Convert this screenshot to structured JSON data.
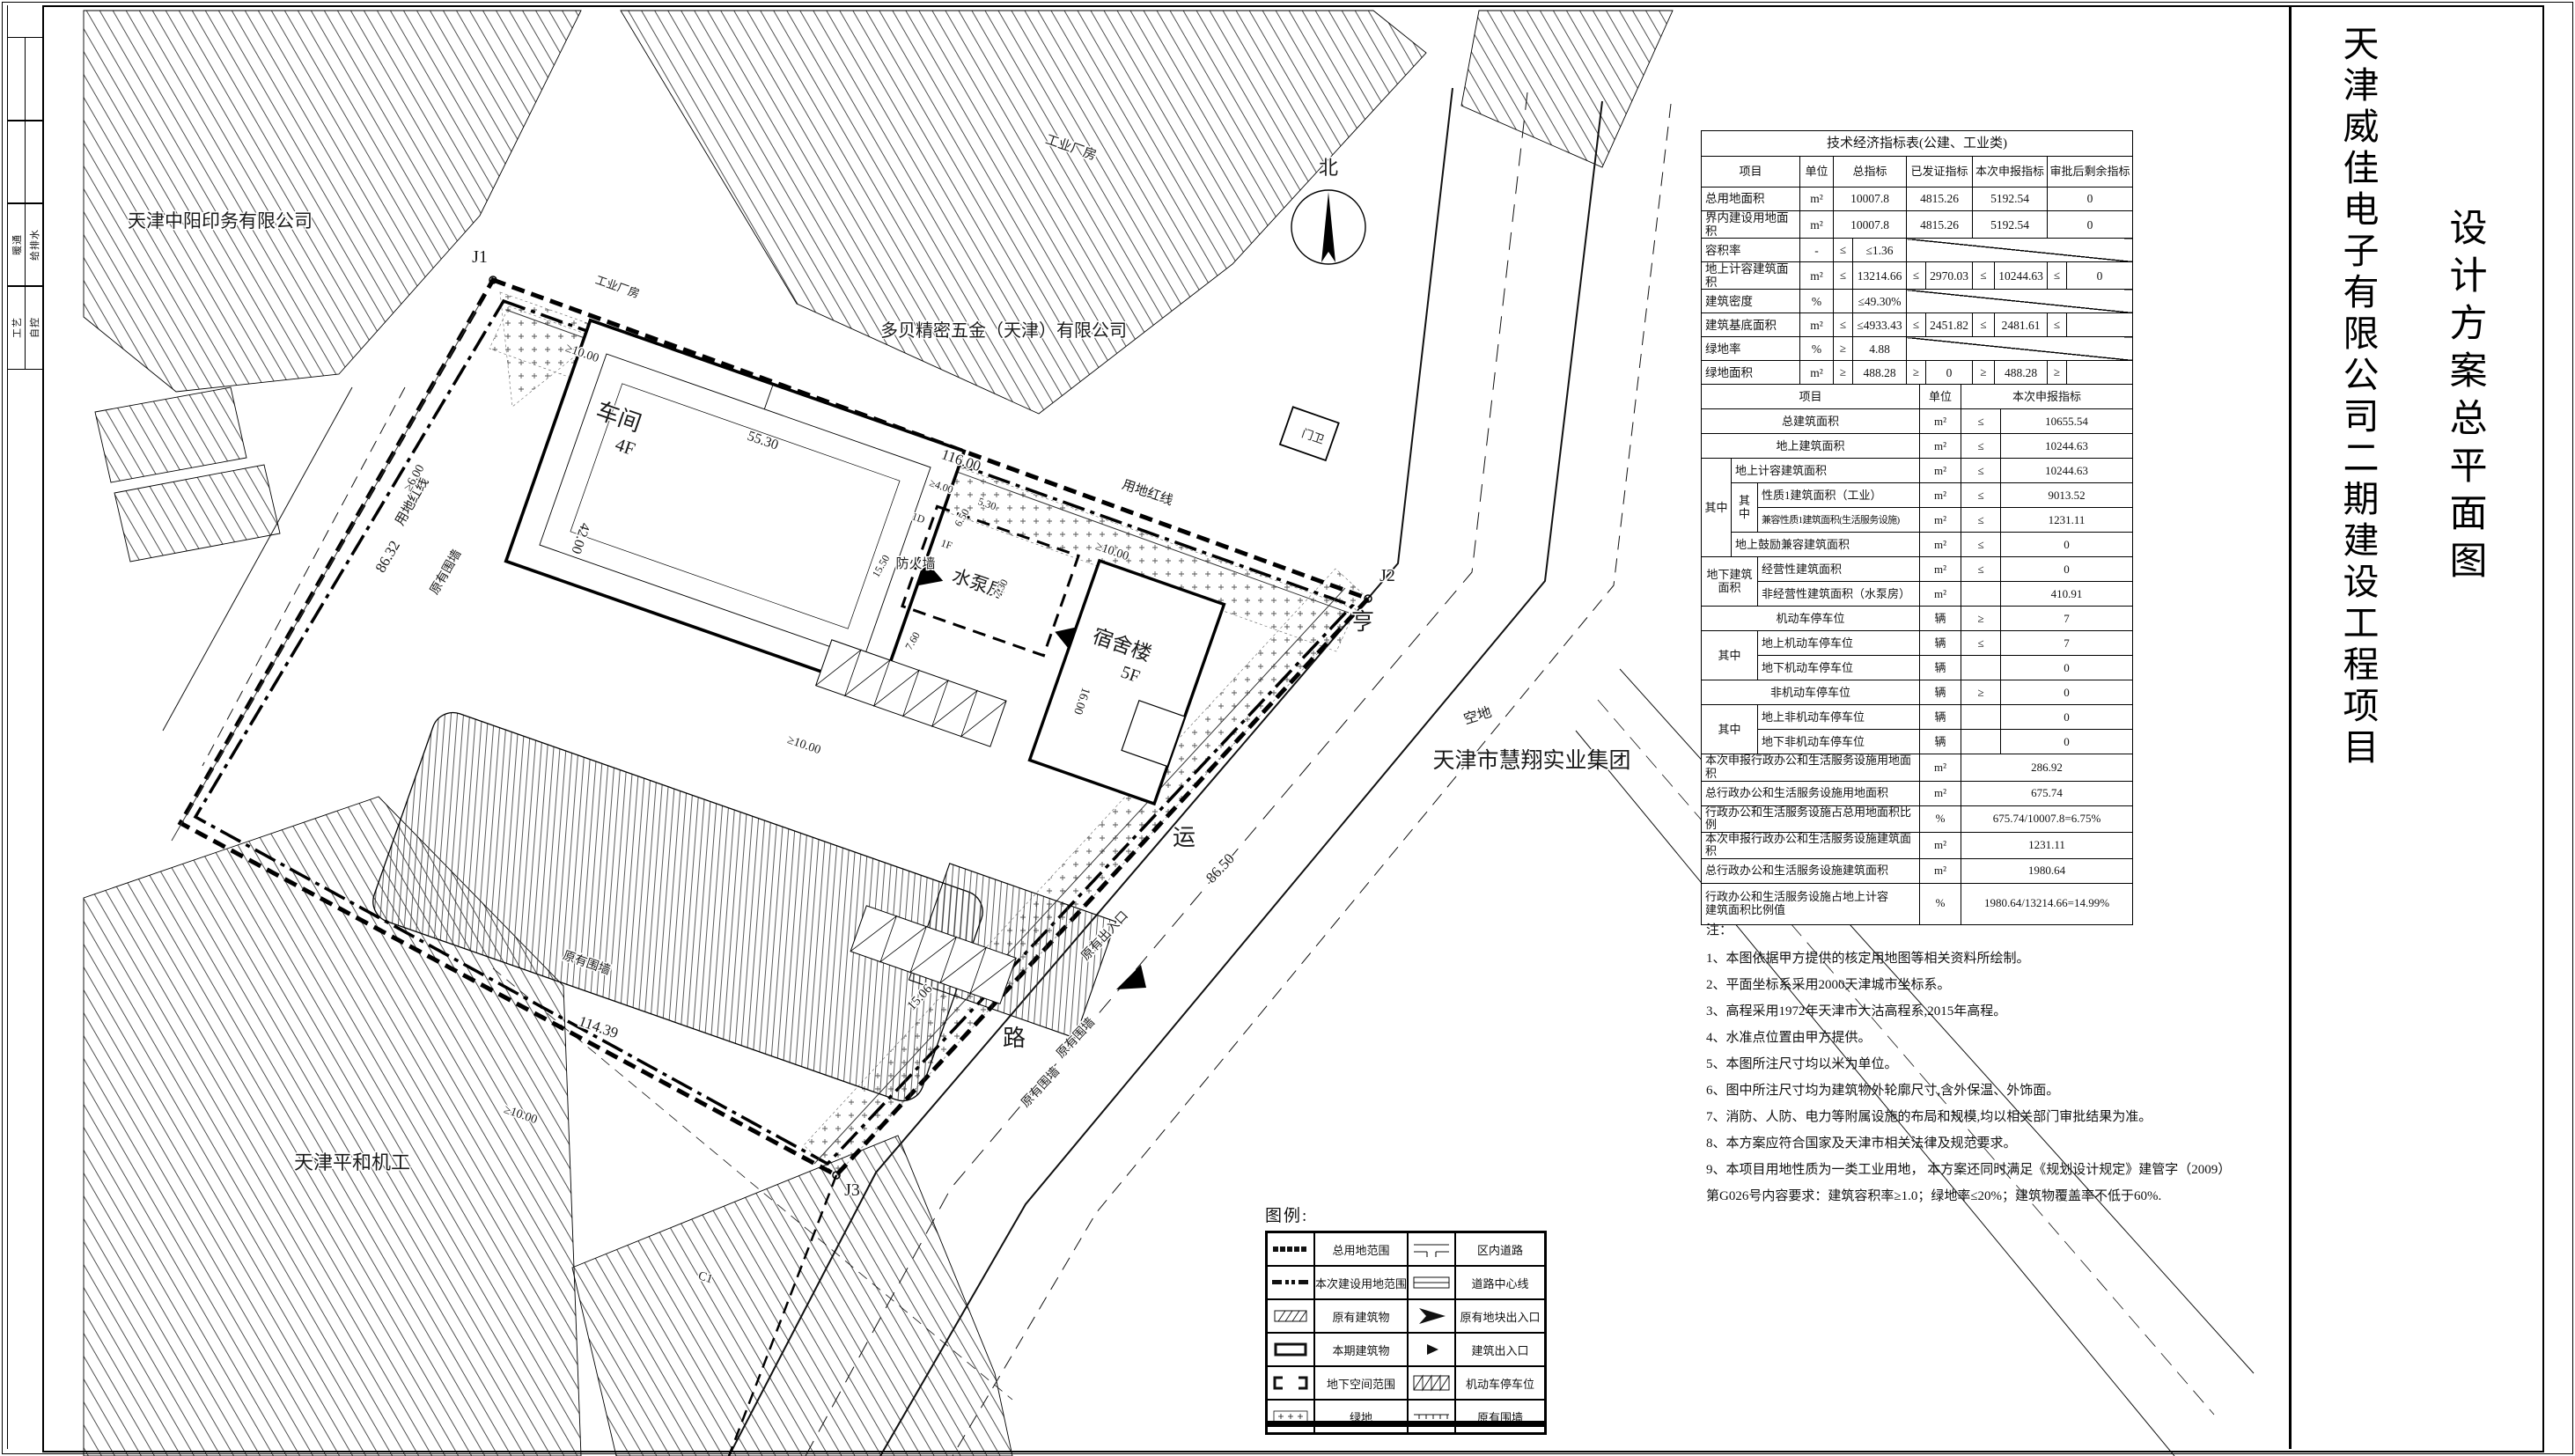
{
  "titles": {
    "project": "天津威佳电子有限公司二期建设工程项目",
    "drawing": "设计方案总平面图"
  },
  "titleblock": {
    "rows": [
      [
        "",
        ""
      ],
      [
        "",
        ""
      ],
      [
        "暖通",
        "给排水"
      ],
      [
        "工艺",
        "自控"
      ]
    ]
  },
  "north": {
    "label": "北"
  },
  "map": {
    "labels": [
      [
        "天津中阳印务有限公司",
        250,
        258,
        0,
        21,
        "#222"
      ],
      [
        "多贝精密五金（天津）有限公司",
        1140,
        382,
        0,
        20,
        "#222"
      ],
      [
        "工业厂房",
        1215,
        172,
        19,
        15,
        "#555"
      ],
      [
        "工业厂房",
        700,
        330,
        19,
        13,
        "#777"
      ],
      [
        "天津平和机工",
        400,
        1328,
        0,
        22,
        "#222"
      ],
      [
        "天津市慧翔实业集团",
        1740,
        872,
        0,
        25,
        "#111"
      ],
      [
        "空地",
        1680,
        818,
        -17,
        16,
        "#444"
      ],
      [
        "C1",
        800,
        1455,
        19,
        14,
        "#666"
      ],
      [
        "亨",
        1548,
        715,
        0,
        26,
        "#111"
      ],
      [
        "运",
        1345,
        960,
        0,
        26,
        "#111"
      ],
      [
        "路",
        1152,
        1188,
        0,
        26,
        "#111"
      ],
      [
        "车间",
        700,
        482,
        19,
        26,
        "#333"
      ],
      [
        "4F",
        708,
        514,
        19,
        21,
        "#333"
      ],
      [
        "宿舍楼",
        1272,
        740,
        19,
        23,
        "#333"
      ],
      [
        "5F",
        1282,
        772,
        19,
        20,
        "#333"
      ],
      [
        "水泵房",
        1110,
        670,
        19,
        21,
        "#333"
      ],
      [
        "门卫",
        1490,
        500,
        19,
        13,
        "#444"
      ],
      [
        "1D",
        1042,
        592,
        19,
        12,
        "#666"
      ],
      [
        "1F",
        1074,
        622,
        19,
        12,
        "#666"
      ],
      [
        "J1",
        545,
        298,
        0,
        20,
        "#111"
      ],
      [
        "J2",
        1576,
        660,
        0,
        20,
        "#111"
      ],
      [
        "J3",
        968,
        1358,
        0,
        20,
        "#111"
      ],
      [
        "用地红线",
        1302,
        564,
        19,
        15,
        "#111"
      ],
      [
        "用地红线",
        472,
        572,
        -60,
        15,
        "#111"
      ],
      [
        "原有围墙",
        510,
        652,
        -60,
        14,
        "#111"
      ],
      [
        "原有围墙",
        665,
        1098,
        19,
        14,
        "#111"
      ],
      [
        "原有围墙",
        1225,
        1182,
        -47,
        14,
        "#111"
      ],
      [
        "原有围墙",
        1185,
        1238,
        -47,
        14,
        "#111"
      ],
      [
        "防火墙",
        1040,
        645,
        0,
        15,
        "#111"
      ],
      [
        "原有出入口",
        1258,
        1066,
        -47,
        14,
        "#111"
      ],
      [
        "北",
        1509,
        198,
        0,
        22,
        "#111"
      ],
      [
        "116.00",
        1090,
        528,
        19,
        17,
        "#111"
      ],
      [
        "55.30",
        865,
        505,
        19,
        16,
        "#111"
      ],
      [
        "42.00",
        655,
        610,
        109,
        16,
        "#111"
      ],
      [
        "86.32",
        445,
        635,
        -60,
        17,
        "#111"
      ],
      [
        "114.39",
        678,
        1172,
        19,
        17,
        "#111"
      ],
      [
        "86.50",
        1390,
        990,
        -47,
        17,
        "#111"
      ],
      [
        "15.06",
        1048,
        1136,
        -47,
        15,
        "#111"
      ],
      [
        "≥10.00",
        660,
        405,
        19,
        14,
        "#111"
      ],
      [
        "≥10.00",
        1262,
        630,
        19,
        14,
        "#111"
      ],
      [
        "≥10.00",
        912,
        850,
        19,
        14,
        "#111"
      ],
      [
        "≥10.00",
        590,
        1270,
        19,
        14,
        "#111"
      ],
      [
        "≥6.00",
        474,
        545,
        -60,
        14,
        "#111"
      ],
      [
        "≥4.00",
        1068,
        556,
        19,
        12,
        "#111"
      ],
      [
        "5.30",
        1120,
        576,
        19,
        12,
        "#111"
      ],
      [
        "15.50",
        1004,
        645,
        -60,
        12,
        "#111"
      ],
      [
        "7.60",
        1040,
        730,
        -60,
        12,
        "#111"
      ],
      [
        "7.30",
        1140,
        670,
        -60,
        12,
        "#111"
      ],
      [
        "6.50",
        1096,
        590,
        -60,
        12,
        "#111"
      ],
      [
        "16.00",
        1225,
        795,
        109,
        14,
        "#111"
      ]
    ]
  },
  "table": {
    "title": "技术经济指标表(公建、工业类)",
    "header": [
      "项目",
      "单位",
      "总指标",
      "已发证指标",
      "本次申报指标",
      "审批后剩余指标"
    ],
    "rows_a": [
      [
        "总用地面积",
        "m²",
        "10007.8",
        "4815.26",
        "5192.54",
        "0"
      ],
      [
        "界内建设用地面积",
        "m²",
        "10007.8",
        "4815.26",
        "5192.54",
        "0"
      ],
      {
        "label": "容积率",
        "unit": "-",
        "sym": "≤",
        "val": "≤1.36",
        "diag": true
      },
      {
        "label": "地上计容建筑面积",
        "unit": "m²",
        "cells": [
          [
            "≤",
            "13214.66"
          ],
          [
            "≤",
            "2970.03"
          ],
          [
            "≤",
            "10244.63"
          ],
          [
            "≤",
            "0"
          ]
        ]
      },
      {
        "label": "建筑密度",
        "unit": "%",
        "sym": "",
        "val": "≤49.30%",
        "diag": true
      },
      {
        "label": "建筑基底面积",
        "unit": "m²",
        "cells": [
          [
            "≤",
            "≤4933.43"
          ],
          [
            "≤",
            "2451.82"
          ],
          [
            "≤",
            "2481.61"
          ],
          [
            "≤",
            ""
          ]
        ]
      },
      {
        "label": "绿地率",
        "unit": "%",
        "sym": "≥",
        "val": "4.88",
        "diag": true
      },
      {
        "label": "绿地面积",
        "unit": "m²",
        "cells": [
          [
            "≥",
            "488.28"
          ],
          [
            "≥",
            "0"
          ],
          [
            "≥",
            "488.28"
          ],
          [
            "≥",
            ""
          ]
        ]
      }
    ],
    "header_b": [
      "项目",
      "单位",
      "本次申报指标"
    ],
    "rows_b": [
      {
        "label": "总建筑面积",
        "unit": "m²",
        "sym": "≤",
        "val": "10655.54",
        "span": 3
      },
      {
        "label": "地上建筑面积",
        "unit": "m²",
        "sym": "≤",
        "val": "10244.63",
        "span": 3
      },
      {
        "g1": "其中",
        "g1rs": 4,
        "label": "地上计容建筑面积",
        "unit": "m²",
        "sym": "≤",
        "val": "10244.63",
        "span": 2
      },
      {
        "g2": "其中",
        "g2rs": 2,
        "label": "性质1建筑面积（工业）",
        "unit": "m²",
        "sym": "≤",
        "val": "9013.52",
        "span": 1
      },
      {
        "label": "兼容性质1建筑面积(生活服务设施)",
        "unit": "m²",
        "sym": "≤",
        "val": "1231.11",
        "span": 1,
        "small": true
      },
      {
        "label": "地上鼓励兼容建筑面积",
        "unit": "m²",
        "sym": "≤",
        "val": "0",
        "span": 2
      },
      {
        "g1": "地下建筑面积",
        "g1rs": 2,
        "g1cs": 2,
        "label": "经营性建筑面积",
        "unit": "m²",
        "sym": "≤",
        "val": "0",
        "span": 1
      },
      {
        "label": "非经营性建筑面积（水泵房）",
        "unit": "m²",
        "sym": "",
        "val": "410.91",
        "span": 1
      },
      {
        "label": "机动车停车位",
        "unit": "辆",
        "sym": "≥",
        "val": "7",
        "span": 3
      },
      {
        "g1": "其中",
        "g1rs": 2,
        "g1cs": 2,
        "label": "地上机动车停车位",
        "unit": "辆",
        "sym": "≤",
        "val": "7",
        "span": 1
      },
      {
        "label": "地下机动车停车位",
        "unit": "辆",
        "sym": "",
        "val": "0",
        "span": 1
      },
      {
        "label": "非机动车停车位",
        "unit": "辆",
        "sym": "≥",
        "val": "0",
        "span": 3
      },
      {
        "g1": "其中",
        "g1rs": 2,
        "g1cs": 2,
        "label": "地上非机动车停车位",
        "unit": "辆",
        "sym": "",
        "val": "0",
        "span": 1
      },
      {
        "label": "地下非机动车停车位",
        "unit": "辆",
        "sym": "",
        "val": "0",
        "span": 1
      },
      {
        "label": "本次申报行政办公和生活服务设施用地面积",
        "unit": "m²",
        "val": "286.92",
        "span": 3,
        "wide": true
      },
      {
        "label": "总行政办公和生活服务设施用地面积",
        "unit": "m²",
        "val": "675.74",
        "span": 3,
        "wide": true
      },
      {
        "label": "行政办公和生活服务设施占总用地面积比例",
        "unit": "%",
        "val": "675.74/10007.8=6.75%",
        "span": 3,
        "wide": true
      },
      {
        "label": "本次申报行政办公和生活服务设施建筑面积",
        "unit": "m²",
        "val": "1231.11",
        "span": 3,
        "wide": true
      },
      {
        "label": "总行政办公和生活服务设施建筑面积",
        "unit": "m²",
        "val": "1980.64",
        "span": 3,
        "wide": true
      },
      {
        "label": "行政办公和生活服务设施占地上计容\n建筑面积比例值",
        "unit": "%",
        "val": "1980.64/13214.66=14.99%",
        "span": 3,
        "wide": true,
        "tall": true
      }
    ]
  },
  "notes": {
    "heading": "注：",
    "items": [
      "1、本图依据甲方提供的核定用地图等相关资料所绘制。",
      "2、平面坐标系采用2000天津城市坐标系。",
      "3、高程采用1972年天津市大沽高程系,2015年高程。",
      "4、水准点位置由甲方提供。",
      "5、本图所注尺寸均以米为单位。",
      "6、图中所注尺寸均为建筑物外轮廓尺寸,含外保温、外饰面。",
      "7、消防、人防、电力等附属设施的布局和规模,均以相关部门审批结果为准。",
      "8、本方案应符合国家及天津市相关法律及规范要求。",
      "9、本项目用地性质为一类工业用地， 本方案还同时满足《规划设计规定》建管字（2009）\n第G026号内容要求：建筑容积率≥1.0；绿地率≤20%；建筑物覆盖率不低于60%."
    ]
  },
  "legend": {
    "title": "图例:",
    "items": [
      {
        "sym": "dash-bold",
        "label": "总用地范围"
      },
      {
        "sym": "road",
        "label": "区内道路"
      },
      {
        "sym": "dashdot-bold",
        "label": "本次建设用地范围"
      },
      {
        "sym": "centerline",
        "label": "道路中心线"
      },
      {
        "sym": "hatch-rect",
        "label": "原有建筑物"
      },
      {
        "sym": "arrow-big",
        "label": "原有地块出入口"
      },
      {
        "sym": "bold-rect",
        "label": "本期建筑物"
      },
      {
        "sym": "arrow-small",
        "label": "建筑出入口"
      },
      {
        "sym": "underground",
        "label": "地下空间范围"
      },
      {
        "sym": "parking",
        "label": "机动车停车位"
      },
      {
        "sym": "green-rect",
        "label": "绿地"
      },
      {
        "sym": "wall",
        "label": "原有围墙"
      }
    ]
  }
}
